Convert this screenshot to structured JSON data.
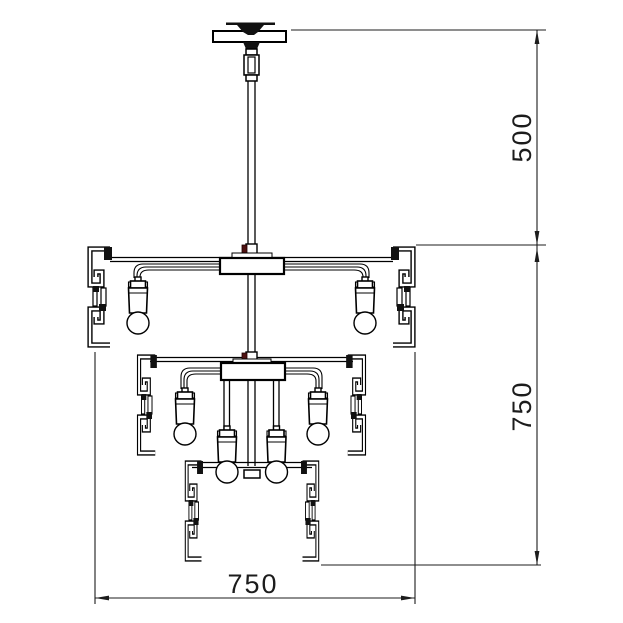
{
  "drawing": {
    "background": "#ffffff",
    "line_color": "#000000",
    "dimension_color": "#1c1c1c",
    "clamp_accent_color": "#4e1111"
  },
  "dimensions": {
    "upper_height": "500",
    "lower_height": "750",
    "width": "750"
  }
}
